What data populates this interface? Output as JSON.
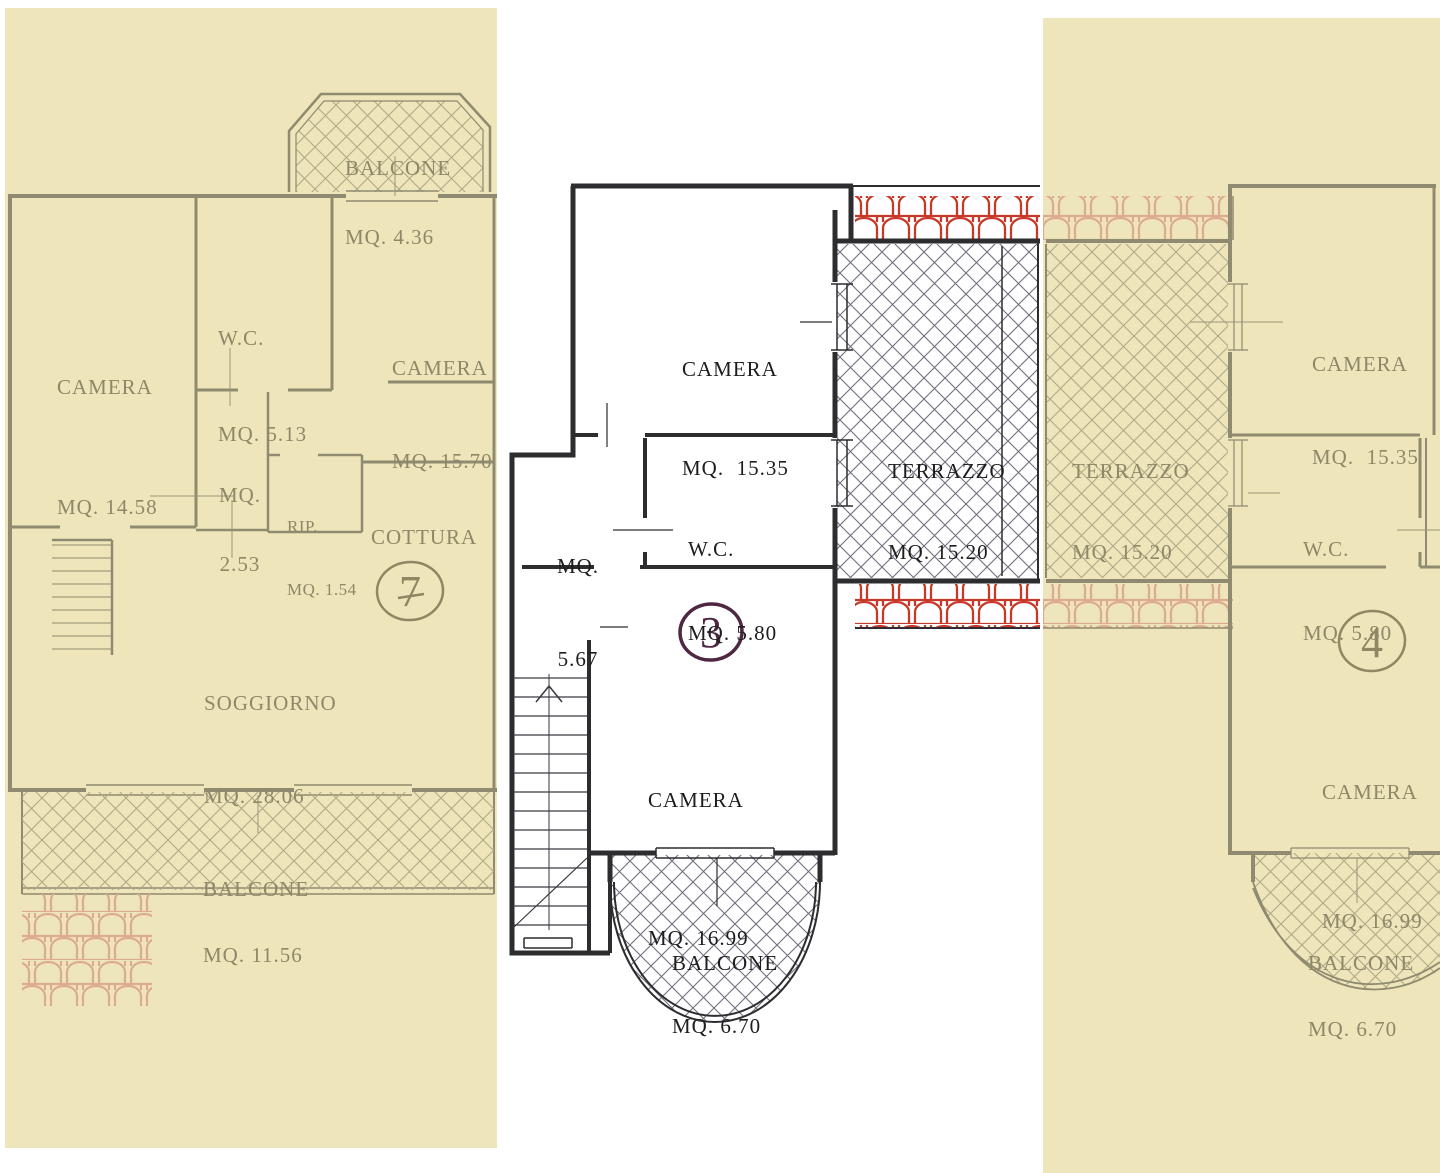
{
  "page": {
    "background": "#ffffff"
  },
  "colors": {
    "paper_overlay": "#eee6ba",
    "ink_dark": "#2d2d30",
    "ink_faded": "#8f8a70",
    "label_dark": "#1d1d1d",
    "label_faded": "#8e8768",
    "hatch_dark": "#6e6e7e",
    "hatch_faded": "#b0a987",
    "tile_red": "#c5392a",
    "tile_red_faded": "#dcaa90",
    "handwriting_ink": "#4e2742"
  },
  "plan": {
    "unit_left": {
      "id_label": "7",
      "rooms": [
        {
          "name": "BALCONE",
          "area": "MQ. 4.36"
        },
        {
          "name": "CAMERA",
          "area": "MQ. 14.58"
        },
        {
          "name": "W.C.",
          "area": "MQ. 5.13"
        },
        {
          "name": "CAMERA",
          "area": "MQ. 15.70"
        },
        {
          "name": "MQ.",
          "area": "2.53"
        },
        {
          "name": "RIP.",
          "area": "MQ. 1.54"
        },
        {
          "name": "COTTURA",
          "area": ""
        },
        {
          "name": "SOGGIORNO",
          "area": "MQ. 28.06"
        },
        {
          "name": "BALCONE",
          "area": "MQ. 11.56"
        }
      ]
    },
    "unit_center": {
      "id_label": "3",
      "rooms": [
        {
          "name": "CAMERA",
          "area": "MQ.  15.35"
        },
        {
          "name": "TERRAZZO",
          "area": "MQ. 15.20"
        },
        {
          "name": "MQ.",
          "area": "5.67"
        },
        {
          "name": "W.C.",
          "area": "MQ. 5.80"
        },
        {
          "name": "CAMERA",
          "area": "MQ. 16.99"
        },
        {
          "name": "BALCONE",
          "area": "MQ. 6.70"
        }
      ]
    },
    "unit_right": {
      "id_label": "4",
      "rooms": [
        {
          "name": "TERRAZZO",
          "area": "MQ. 15.20"
        },
        {
          "name": "CAMERA",
          "area": "MQ.  15.35"
        },
        {
          "name": "W.C.",
          "area": "MQ. 5.80"
        },
        {
          "name": "CAMERA",
          "area": "MQ. 16.99"
        },
        {
          "name": "BALCONE",
          "area": "MQ. 6.70"
        }
      ]
    }
  }
}
